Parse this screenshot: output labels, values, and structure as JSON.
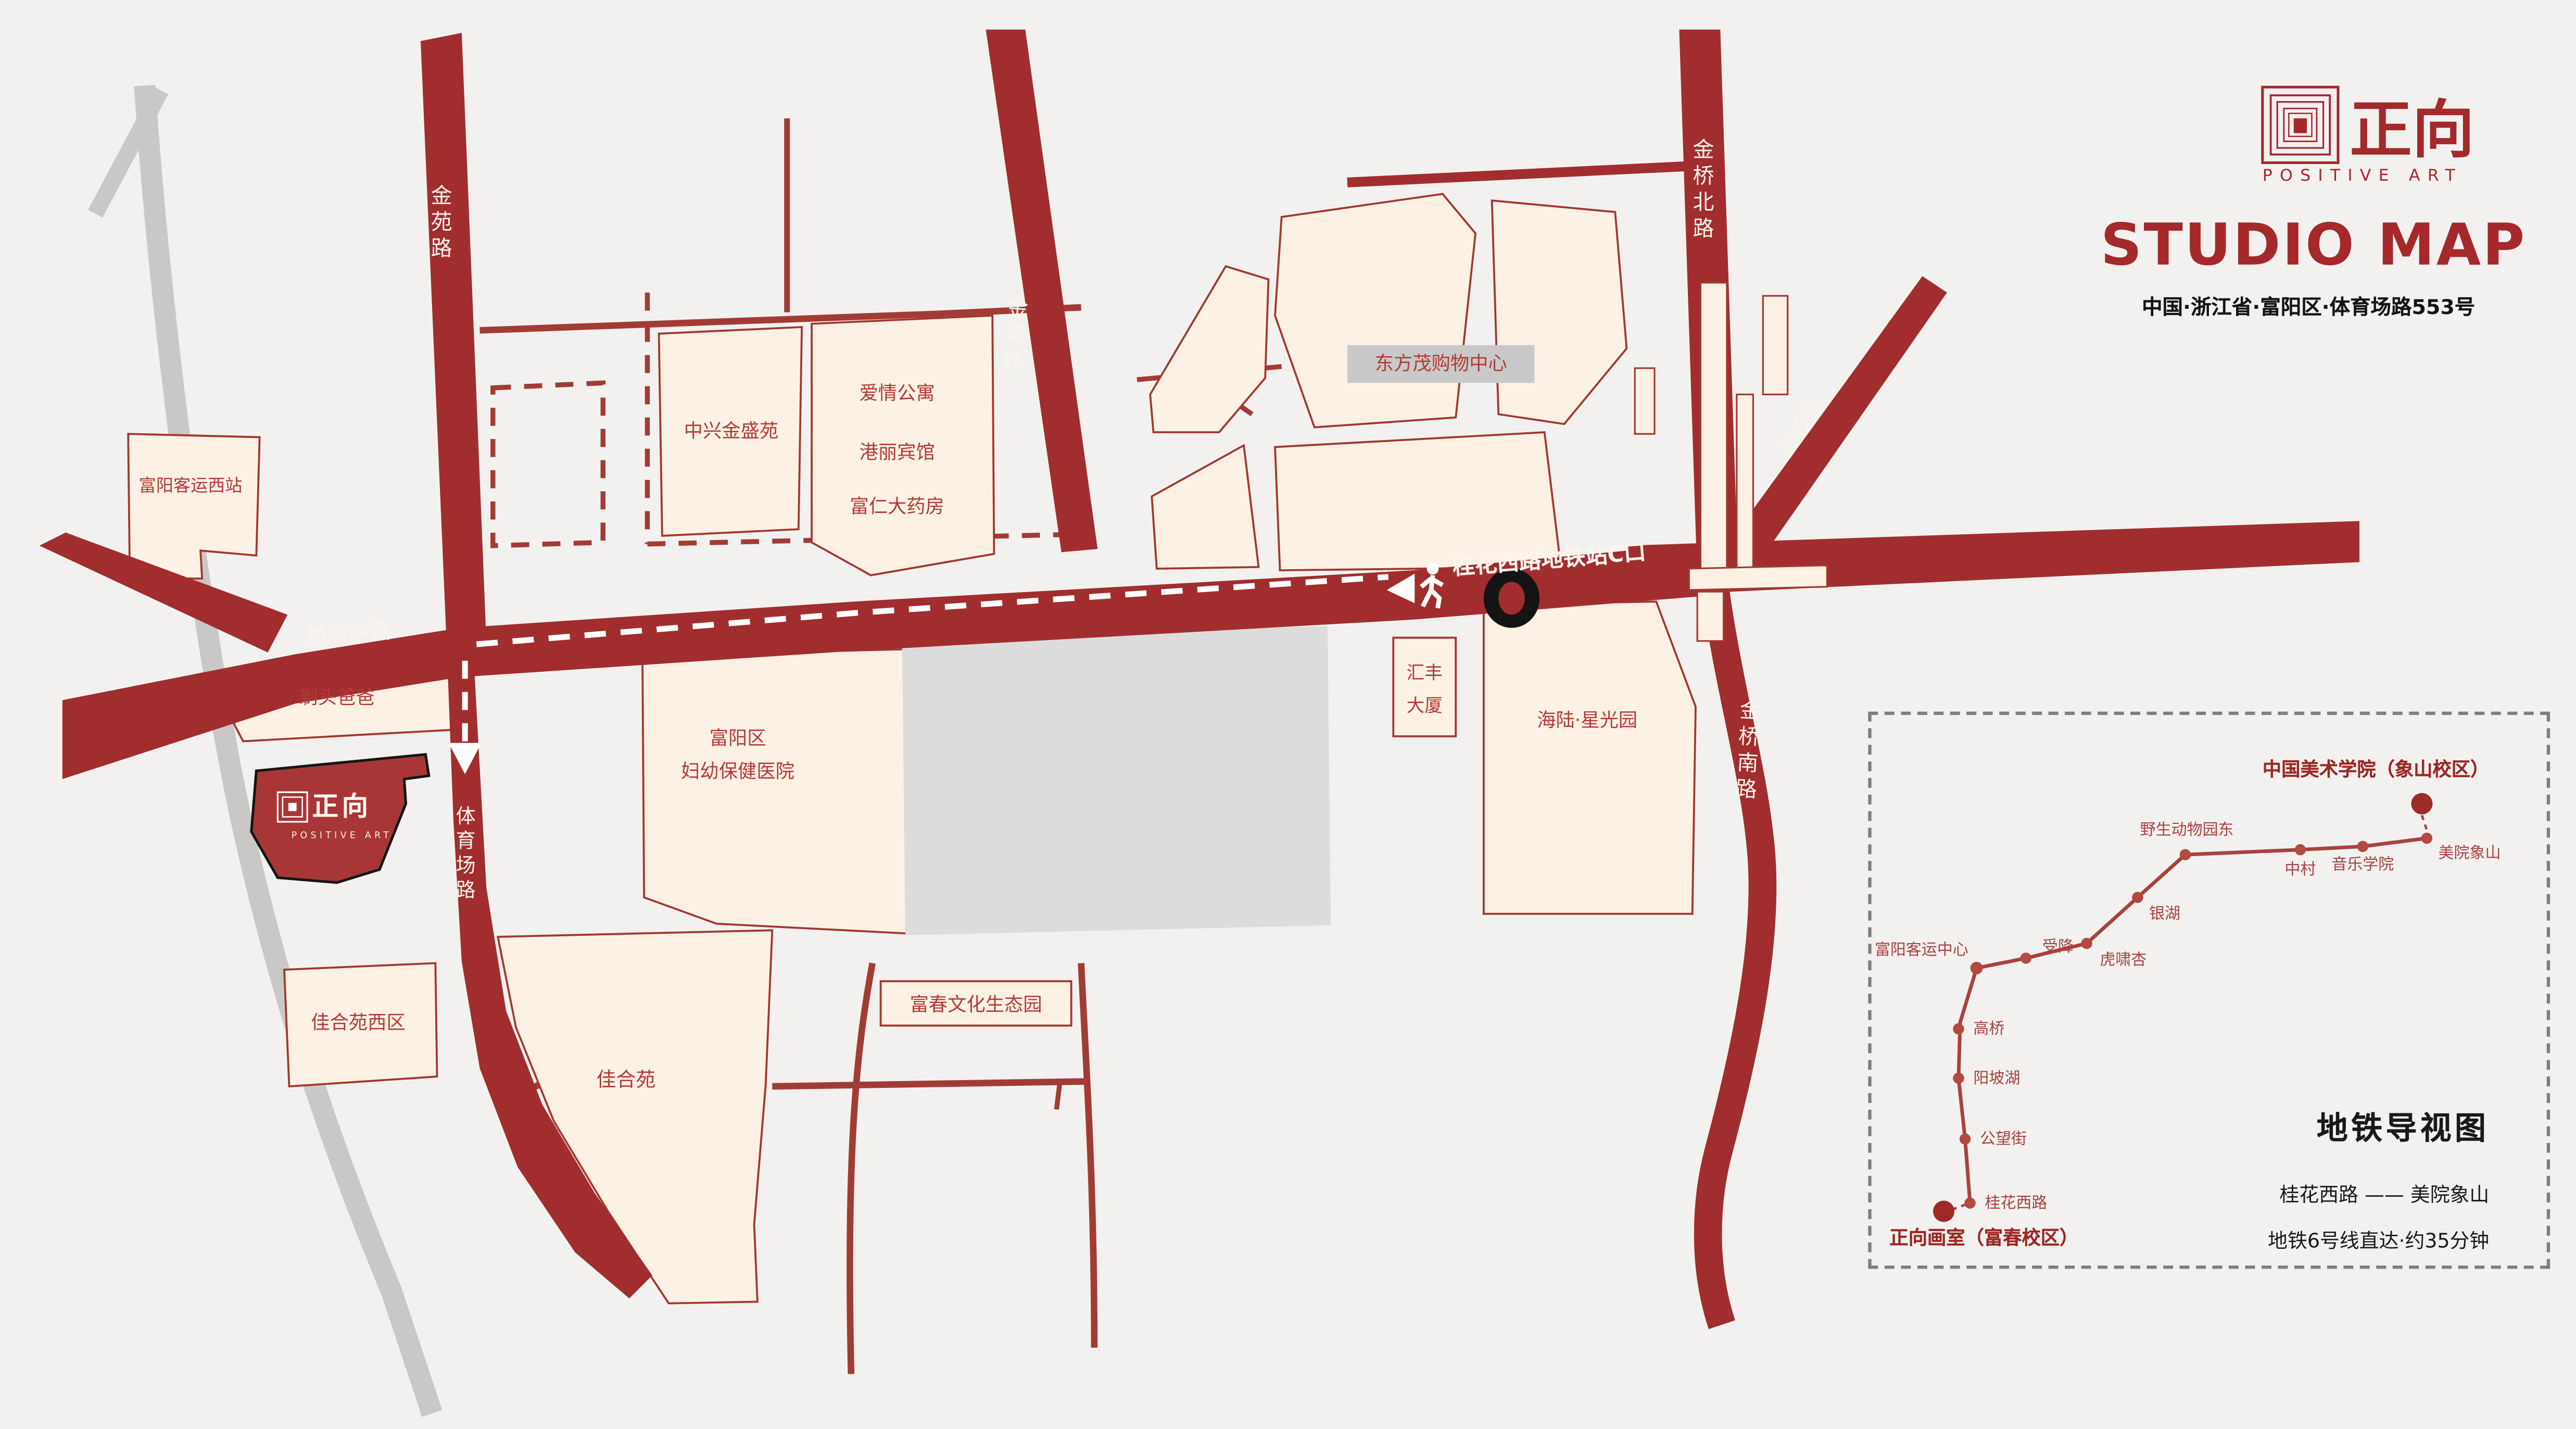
{
  "brand": {
    "logo_zh": "正向",
    "logo_en": "POSITIVE ART",
    "title": "STUDIO MAP",
    "address": "中国·浙江省·富阳区·体育场路553号"
  },
  "roads": {
    "jinyuan": "金苑路",
    "hengliangting": "横凉亭路",
    "jinpu": "金浦路",
    "jinqiao_north": "金桥北路",
    "sunquan": "孙权路",
    "jinqiao_south": "金桥南路",
    "tiyuchang": "体育场路",
    "metro_entrance": "桂花西路地铁站C口"
  },
  "buildings": {
    "west_bus_station": "富阳客运西站",
    "zhongxing": "中兴金盛苑",
    "aiqing": "爱情公寓",
    "gangli": "港丽宾馆",
    "furen": "富仁大药房",
    "dongfangmao": "东方茂购物中心",
    "titou": "剃头爸爸",
    "hospital1": "富阳区",
    "hospital2": "妇幼保健医院",
    "huifeng1": "汇丰",
    "huifeng2": "大厦",
    "hailu": "海陆·星光园",
    "jiaheyuan_west": "佳合苑西区",
    "jiaheyuan": "佳合苑",
    "fuchun_park": "富春文化生态园"
  },
  "metro": {
    "campus": "中国美术学院（象山校区）",
    "studio": "正向画室（富春校区）",
    "title": "地铁导视图",
    "route": "桂花西路 —— 美院象山",
    "note": "地铁6号线直达·约35分钟",
    "stations": [
      "美院象山",
      "音乐学院",
      "中村",
      "野生动物园东",
      "银湖",
      "虎啸杏",
      "受降",
      "富阳客运中心",
      "高桥",
      "阳坡湖",
      "公望街",
      "桂花西路"
    ]
  },
  "colors": {
    "road_red": "#a12d2f",
    "building_fill": "#fdf1e5",
    "accent_red": "#a5282b",
    "label_red": "#b23a36",
    "gray_block": "#dcdcdc"
  }
}
